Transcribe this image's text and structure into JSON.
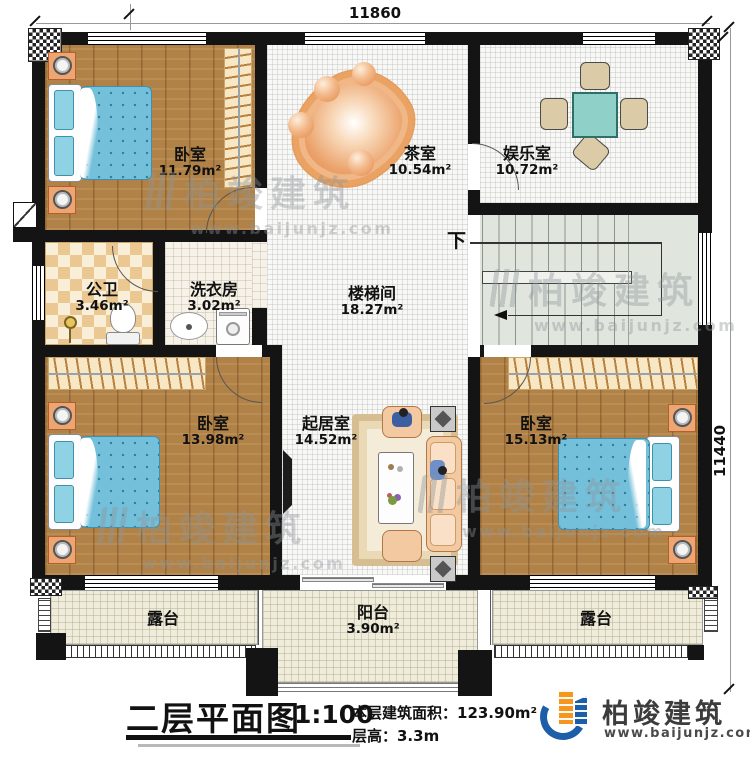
{
  "plan": {
    "dimensions": {
      "width_top": "11860",
      "height_right": "11440"
    },
    "rooms": {
      "bedroom_tl": {
        "name": "卧室",
        "area": "11.79m²"
      },
      "tea": {
        "name": "茶室",
        "area": "10.54m²"
      },
      "entertainment": {
        "name": "娱乐室",
        "area": "10.72m²"
      },
      "bath": {
        "name": "公卫",
        "area": "3.46m²"
      },
      "laundry": {
        "name": "洗衣房",
        "area": "3.02m²"
      },
      "stairwell": {
        "name": "楼梯间",
        "area": "18.27m²"
      },
      "bedroom_bl": {
        "name": "卧室",
        "area": "13.98m²"
      },
      "living": {
        "name": "起居室",
        "area": "14.52m²"
      },
      "bedroom_br": {
        "name": "卧室",
        "area": "15.13m²"
      },
      "terrace_left": {
        "name": "露台"
      },
      "balcony": {
        "name": "阳台",
        "area": "3.90m²"
      },
      "terrace_right": {
        "name": "露台"
      }
    },
    "stairs": {
      "down_label": "下"
    }
  },
  "title_block": {
    "title": "二层平面图",
    "scale": "1:100",
    "area_label": "本层建筑面积：123.90m²",
    "height_label": "层高：3.3m"
  },
  "brand": {
    "name": "柏竣建筑",
    "website": "www.baijunjz.com"
  },
  "colors": {
    "wall": "#141414",
    "wood_floor": "#b18247",
    "bed": "#74c0da",
    "stair_floor": "#e0e6de",
    "terrace_floor": "#efecdb",
    "logo_blue": "#1c5fa8",
    "logo_orange": "#f5971d"
  }
}
